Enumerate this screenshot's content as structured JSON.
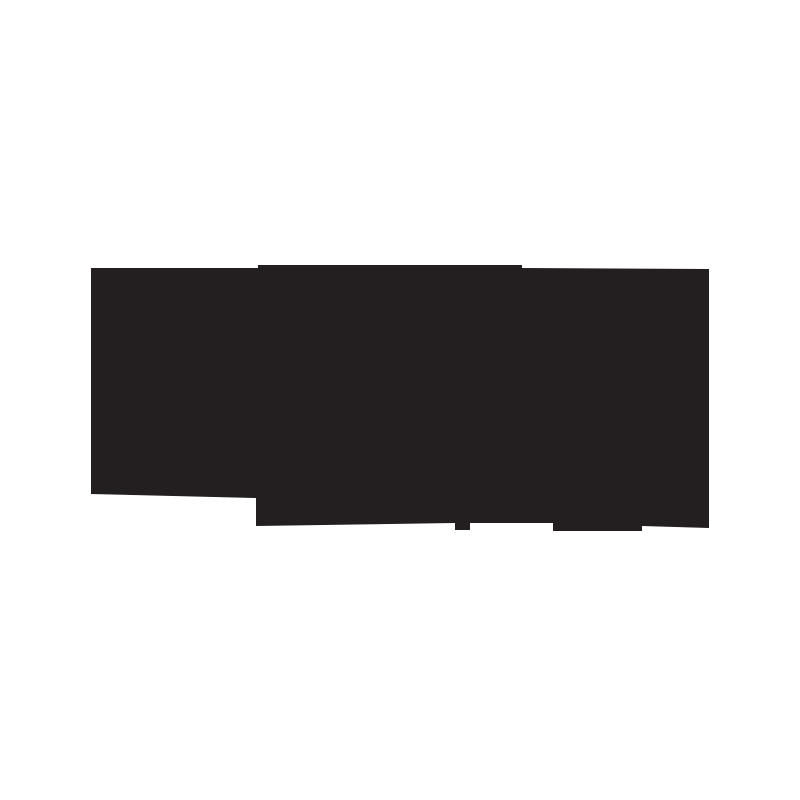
{
  "canvas": {
    "width": 800,
    "height": 800,
    "background_color": "#ffffff"
  },
  "silhouette": {
    "name": "black-silhouette-graphic",
    "description": "solid dark irregular blocky silhouette centered on white background, no text or internal detail",
    "color": "#231f20",
    "bounding_box": {
      "x": 91,
      "y": 265,
      "width": 618,
      "height": 266
    },
    "points": "91,268 258,268 258,265 522,265 522,268 709,269 709,528 642,526 642,531 553,531 553,523 470,523 470,530 455,530 455,523 256,526 256,498 91,494"
  }
}
